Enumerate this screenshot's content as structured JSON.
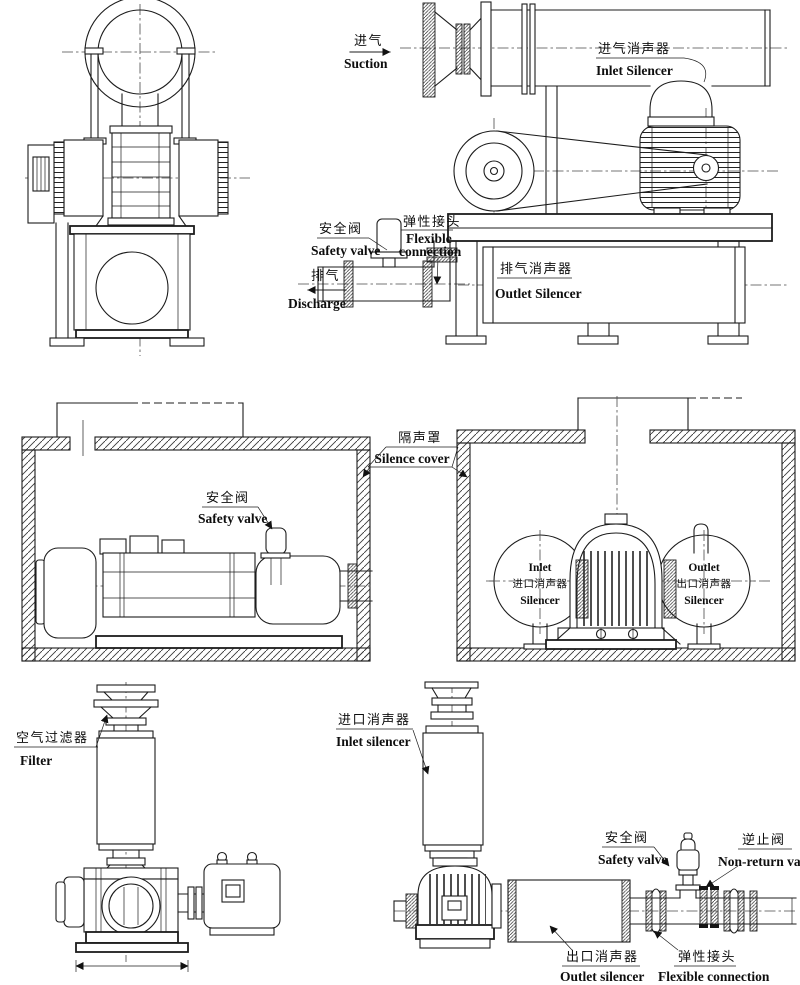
{
  "colors": {
    "ink": "#1c1c1c",
    "paper": "#ffffff"
  },
  "figures": {
    "top_right": {
      "suction_zh": "进气",
      "suction_en": "Suction",
      "inlet_silencer_zh": "进气消声器",
      "inlet_silencer_en": "Inlet Silencer",
      "safety_valve_zh": "安全阀",
      "safety_valve_en": "Safety valve",
      "flexible_zh": "弹性接头",
      "flexible_en1": "Flexible",
      "flexible_en2": "connection",
      "discharge_zh": "排气",
      "discharge_en": "Discharge",
      "outlet_silencer_zh": "排气消声器",
      "outlet_silencer_en": "Outlet Silencer"
    },
    "enclosures": {
      "safety_valve_zh": "安全阀",
      "safety_valve_en": "Safety valve",
      "silence_cover_zh": "隔声罩",
      "silence_cover_en": "Silence cover",
      "inlet_circle_en1": "Inlet",
      "inlet_circle_zh": "进口消声器",
      "inlet_circle_en2": "Silencer",
      "outlet_circle_en1": "Outlet",
      "outlet_circle_zh": "出口消声器",
      "outlet_circle_en2": "Silencer"
    },
    "bottom_left": {
      "filter_zh": "空气过滤器",
      "filter_en": "Filter"
    },
    "bottom_right": {
      "inlet_silencer_zh": "进口消声器",
      "inlet_silencer_en": "Inlet silencer",
      "safety_valve_zh": "安全阀",
      "safety_valve_en": "Safety valve",
      "non_return_zh": "逆止阀",
      "non_return_en": "Non-return valve",
      "outlet_silencer_zh": "出口消声器",
      "outlet_silencer_en": "Outlet silencer",
      "flexible_zh": "弹性接头",
      "flexible_en": "Flexible connection"
    }
  }
}
